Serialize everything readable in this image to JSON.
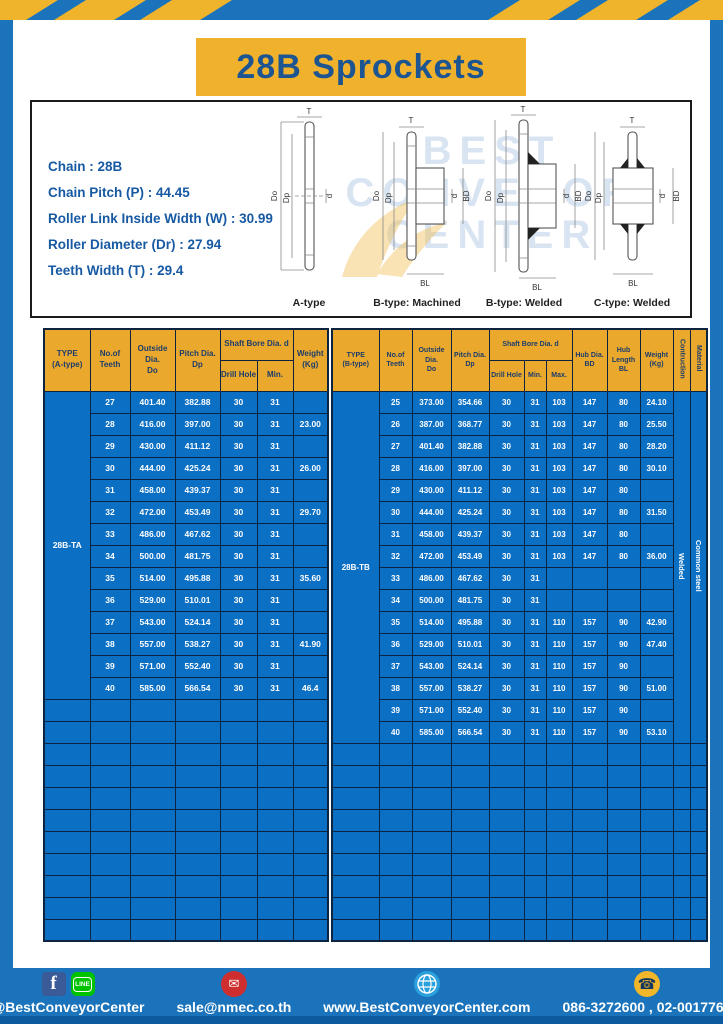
{
  "title": "28B Sprockets",
  "specs": {
    "chain": "Chain : 28B",
    "pitch": "Chain Pitch (P) : 44.45",
    "roller_width": "Roller Link Inside Width (W) : 30.99",
    "roller_dia": "Roller Diameter (Dr) : 27.94",
    "teeth_width": "Teeth Width (T) : 29.4"
  },
  "watermark": {
    "line1": "BEST",
    "line2": "CONVEYOR",
    "line3": "CENTER"
  },
  "drawings": {
    "captions": [
      "A-type",
      "B-type: Machined",
      "B-type: Welded",
      "C-type: Welded"
    ],
    "dims": {
      "t": "T",
      "do": "Do",
      "dp": "Dp",
      "d": "d",
      "bd": "BD",
      "bl": "BL"
    }
  },
  "table_a": {
    "header": {
      "type": "TYPE\n(A-type)",
      "teeth": "No.of\nTeeth",
      "outside": "Outside\nDia.\nDo",
      "pitch": "Pitch Dia.\nDp",
      "shaft": "Shaft Bore Dia. d",
      "drill": "Drill Hole",
      "min": "Min.",
      "weight": "Weight\n(Kg)"
    },
    "type_label": "28B-TA",
    "rows": [
      [
        "27",
        "401.40",
        "382.88",
        "30",
        "31",
        ""
      ],
      [
        "28",
        "416.00",
        "397.00",
        "30",
        "31",
        "23.00"
      ],
      [
        "29",
        "430.00",
        "411.12",
        "30",
        "31",
        ""
      ],
      [
        "30",
        "444.00",
        "425.24",
        "30",
        "31",
        "26.00"
      ],
      [
        "31",
        "458.00",
        "439.37",
        "30",
        "31",
        ""
      ],
      [
        "32",
        "472.00",
        "453.49",
        "30",
        "31",
        "29.70"
      ],
      [
        "33",
        "486.00",
        "467.62",
        "30",
        "31",
        ""
      ],
      [
        "34",
        "500.00",
        "481.75",
        "30",
        "31",
        ""
      ],
      [
        "35",
        "514.00",
        "495.88",
        "30",
        "31",
        "35.60"
      ],
      [
        "36",
        "529.00",
        "510.01",
        "30",
        "31",
        ""
      ],
      [
        "37",
        "543.00",
        "524.14",
        "30",
        "31",
        ""
      ],
      [
        "38",
        "557.00",
        "538.27",
        "30",
        "31",
        "41.90"
      ],
      [
        "39",
        "571.00",
        "552.40",
        "30",
        "31",
        ""
      ],
      [
        "40",
        "585.00",
        "566.54",
        "30",
        "31",
        "46.4"
      ]
    ],
    "empty_rows": 11
  },
  "table_b": {
    "header": {
      "type": "TYPE\n(B-type)",
      "teeth": "No.of\nTeeth",
      "outside": "Outside\nDia.\nDo",
      "pitch": "Pitch Dia.\nDp",
      "shaft": "Shaft Bore Dia. d",
      "drill": "Drill Hole",
      "min": "Min.",
      "max": "Max.",
      "hub_dia": "Hub Dia.\nBD",
      "hub_len": "Hub\nLength\nBL",
      "weight": "Weight\n(Kg)",
      "construction": "Contruction",
      "material": "Material"
    },
    "type_label": "28B-TB",
    "construction": "Welded",
    "material": "Common steel",
    "rows": [
      [
        "25",
        "373.00",
        "354.66",
        "30",
        "31",
        "103",
        "147",
        "80",
        "24.10"
      ],
      [
        "26",
        "387.00",
        "368.77",
        "30",
        "31",
        "103",
        "147",
        "80",
        "25.50"
      ],
      [
        "27",
        "401.40",
        "382.88",
        "30",
        "31",
        "103",
        "147",
        "80",
        "28.20"
      ],
      [
        "28",
        "416.00",
        "397.00",
        "30",
        "31",
        "103",
        "147",
        "80",
        "30.10"
      ],
      [
        "29",
        "430.00",
        "411.12",
        "30",
        "31",
        "103",
        "147",
        "80",
        ""
      ],
      [
        "30",
        "444.00",
        "425.24",
        "30",
        "31",
        "103",
        "147",
        "80",
        "31.50"
      ],
      [
        "31",
        "458.00",
        "439.37",
        "30",
        "31",
        "103",
        "147",
        "80",
        ""
      ],
      [
        "32",
        "472.00",
        "453.49",
        "30",
        "31",
        "103",
        "147",
        "80",
        "36.00"
      ],
      [
        "33",
        "486.00",
        "467.62",
        "30",
        "31",
        "",
        "",
        "",
        ""
      ],
      [
        "34",
        "500.00",
        "481.75",
        "30",
        "31",
        "",
        "",
        "",
        ""
      ],
      [
        "35",
        "514.00",
        "495.88",
        "30",
        "31",
        "110",
        "157",
        "90",
        "42.90"
      ],
      [
        "36",
        "529.00",
        "510.01",
        "30",
        "31",
        "110",
        "157",
        "90",
        "47.40"
      ],
      [
        "37",
        "543.00",
        "524.14",
        "30",
        "31",
        "110",
        "157",
        "90",
        ""
      ],
      [
        "38",
        "557.00",
        "538.27",
        "30",
        "31",
        "110",
        "157",
        "90",
        "51.00"
      ],
      [
        "39",
        "571.00",
        "552.40",
        "30",
        "31",
        "110",
        "157",
        "90",
        ""
      ],
      [
        "40",
        "585.00",
        "566.54",
        "30",
        "31",
        "110",
        "157",
        "90",
        "53.10"
      ]
    ],
    "empty_rows": 9
  },
  "footer": {
    "social": "@BestConveyorCenter",
    "line_label": "LINE",
    "facebook_label": "f",
    "email": "sale@nmec.co.th",
    "website": "www.BestConveyorCenter.com",
    "phone": "086-3272600 , 02-0017766"
  },
  "colors": {
    "frame_blue": "#1a73bb",
    "table_blue": "#0b6fc4",
    "accent_yellow": "#f0b22c",
    "header_yellow": "#eaa92d",
    "navy_text": "#1c3c6b",
    "border_navy": "#0d2440",
    "footer_strip": "#0d5a9e"
  }
}
